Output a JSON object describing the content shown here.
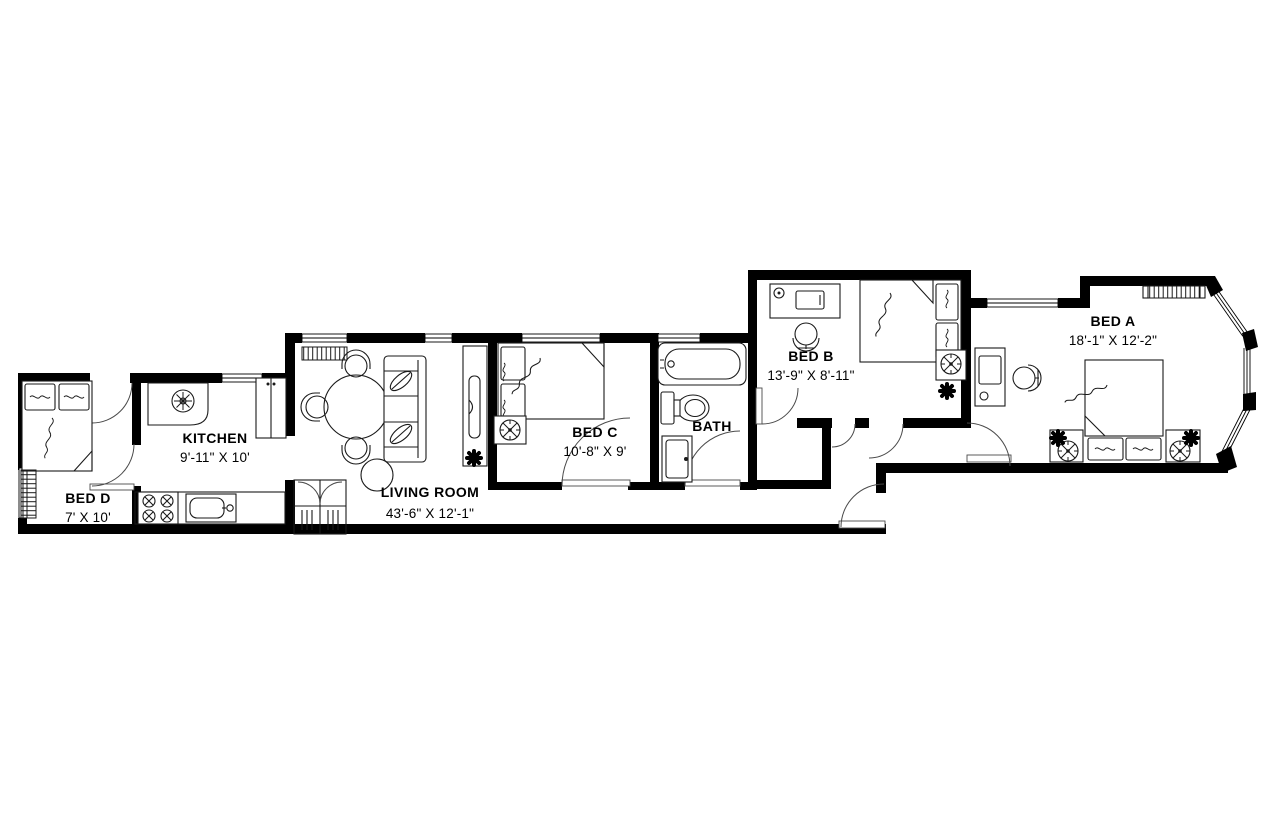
{
  "title": "Apartment floor plan",
  "rooms": {
    "bed_d": {
      "name": "BED D",
      "dims": "7' X 10'"
    },
    "kitchen": {
      "name": "KITCHEN",
      "dims": "9'-11\" X 10'"
    },
    "living": {
      "name": "LIVING ROOM",
      "dims": "43'-6\" X 12'-1\""
    },
    "bed_c": {
      "name": "BED C",
      "dims": "10'-8\" X 9'"
    },
    "bath": {
      "name": "BATH"
    },
    "bed_b": {
      "name": "BED B",
      "dims": "13'-9\" X 8'-11\""
    },
    "bed_a": {
      "name": "BED A",
      "dims": "18'-1\" X 12'-2\""
    }
  },
  "colors": {
    "wall": "#000000",
    "line": "#1a1a1a",
    "background": "#ffffff"
  }
}
